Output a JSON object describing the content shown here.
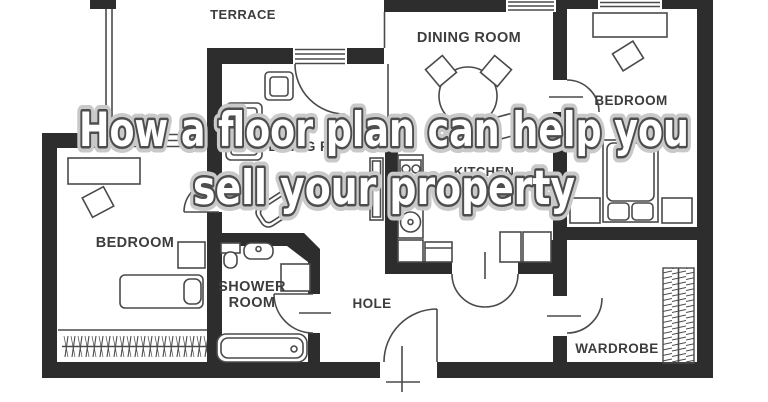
{
  "title": {
    "line1": "How a floor plan can help you",
    "line2": "sell your property"
  },
  "rooms": {
    "terrace": "TERRACE",
    "dining": "DINING ROOM",
    "bedroom_right": "BEDROOM",
    "living": "LIVING ROOM",
    "kitchen": "KITCHEN",
    "bedroom_left": "BEDROOM",
    "shower_line1": "SHOWER",
    "shower_line2": "ROOM",
    "hall": "HOLE",
    "wardrobe": "WARDROBE"
  },
  "colors": {
    "wall": "#2d2d2d",
    "line": "#4a4a4a",
    "label": "#3d3d3d",
    "titleFill": "#ffffff",
    "titleOutline": "#4d4d4d",
    "titleHalo": "#c9c9c9",
    "bg": "#ffffff"
  }
}
